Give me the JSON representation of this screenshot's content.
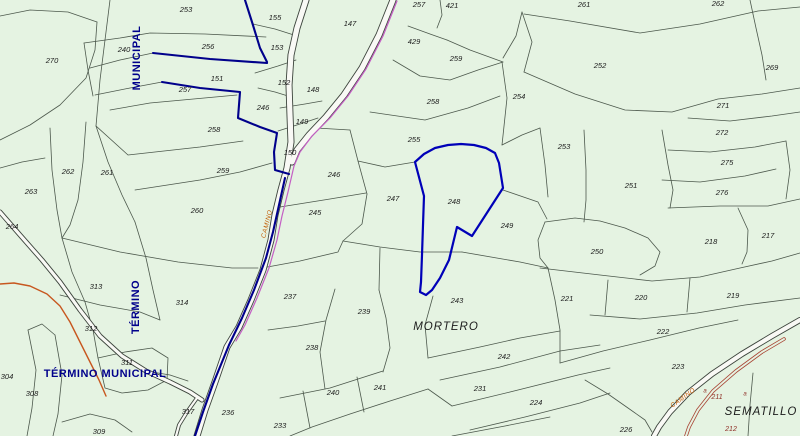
{
  "map": {
    "background_color": "#e5f3e2",
    "parcel_line_color": "#4c584c",
    "road_casing_color": "#3c443c",
    "road_fill_color": "#f9f9f5",
    "highlight_color": "#0000b8",
    "boundary_color": "#00008b",
    "magenta_road_color": "#c45ec4",
    "orange_road_color": "#c7571f",
    "red_path_color": "#a84434",
    "label_color": "#1c1c1c",
    "muni_text_color": "#00008b",
    "camino_text_color": "#c05a00",
    "red_label_color": "#8f2f26",
    "place_names": [
      {
        "t": "MORTERO",
        "x": 446,
        "y": 327
      },
      {
        "t": "SEMATILLO",
        "x": 761,
        "y": 412
      }
    ],
    "municipal_labels": [
      {
        "t": "MUNICIPAL",
        "x": 137,
        "y": 58,
        "r": -90
      },
      {
        "t": "TÉRMINO",
        "x": 136,
        "y": 307,
        "r": -90
      },
      {
        "t": "TÉRMINO MUNICIPAL",
        "x": 105,
        "y": 374,
        "r": 0
      }
    ],
    "camino_labels": [
      {
        "t": "CAMINO",
        "x": 267,
        "y": 224,
        "r": -76
      },
      {
        "t": "CAMINO",
        "x": 683,
        "y": 398,
        "r": -36
      }
    ],
    "red_labels": [
      {
        "t": "211",
        "x": 717,
        "y": 397
      },
      {
        "t": "212",
        "x": 731,
        "y": 429
      },
      {
        "t": "a",
        "x": 705,
        "y": 391
      },
      {
        "t": "a",
        "x": 745,
        "y": 394
      }
    ],
    "parcel_labels": [
      {
        "t": "253",
        "x": 186,
        "y": 10
      },
      {
        "t": "155",
        "x": 275,
        "y": 18
      },
      {
        "t": "147",
        "x": 350,
        "y": 24
      },
      {
        "t": "257",
        "x": 419,
        "y": 5
      },
      {
        "t": "421",
        "x": 452,
        "y": 6
      },
      {
        "t": "429",
        "x": 414,
        "y": 42
      },
      {
        "t": "259",
        "x": 456,
        "y": 59
      },
      {
        "t": "261",
        "x": 584,
        "y": 5
      },
      {
        "t": "262",
        "x": 718,
        "y": 4
      },
      {
        "t": "270",
        "x": 52,
        "y": 61
      },
      {
        "t": "240",
        "x": 124,
        "y": 50
      },
      {
        "t": "256",
        "x": 208,
        "y": 47
      },
      {
        "t": "153",
        "x": 277,
        "y": 48
      },
      {
        "t": "151",
        "x": 217,
        "y": 79
      },
      {
        "t": "257",
        "x": 185,
        "y": 90
      },
      {
        "t": "152",
        "x": 284,
        "y": 83
      },
      {
        "t": "148",
        "x": 313,
        "y": 90
      },
      {
        "t": "246",
        "x": 263,
        "y": 108
      },
      {
        "t": "149",
        "x": 302,
        "y": 122
      },
      {
        "t": "258",
        "x": 214,
        "y": 130
      },
      {
        "t": "254",
        "x": 519,
        "y": 97
      },
      {
        "t": "258",
        "x": 433,
        "y": 102
      },
      {
        "t": "255",
        "x": 414,
        "y": 140
      },
      {
        "t": "252",
        "x": 600,
        "y": 66
      },
      {
        "t": "269",
        "x": 772,
        "y": 68
      },
      {
        "t": "271",
        "x": 723,
        "y": 106
      },
      {
        "t": "272",
        "x": 722,
        "y": 133
      },
      {
        "t": "253",
        "x": 564,
        "y": 147
      },
      {
        "t": "275",
        "x": 727,
        "y": 163
      },
      {
        "t": "251",
        "x": 631,
        "y": 186
      },
      {
        "t": "276",
        "x": 722,
        "y": 193
      },
      {
        "t": "150",
        "x": 290,
        "y": 153
      },
      {
        "t": "259",
        "x": 223,
        "y": 171
      },
      {
        "t": "262",
        "x": 68,
        "y": 172
      },
      {
        "t": "261",
        "x": 107,
        "y": 173
      },
      {
        "t": "263",
        "x": 31,
        "y": 192
      },
      {
        "t": "260",
        "x": 197,
        "y": 211
      },
      {
        "t": "264",
        "x": 12,
        "y": 227
      },
      {
        "t": "246",
        "x": 334,
        "y": 175
      },
      {
        "t": "245",
        "x": 315,
        "y": 213
      },
      {
        "t": "247",
        "x": 393,
        "y": 199
      },
      {
        "t": "248",
        "x": 454,
        "y": 202
      },
      {
        "t": "249",
        "x": 507,
        "y": 226
      },
      {
        "t": "250",
        "x": 597,
        "y": 252
      },
      {
        "t": "218",
        "x": 711,
        "y": 242
      },
      {
        "t": "217",
        "x": 768,
        "y": 236
      },
      {
        "t": "221",
        "x": 567,
        "y": 299
      },
      {
        "t": "220",
        "x": 641,
        "y": 298
      },
      {
        "t": "219",
        "x": 733,
        "y": 296
      },
      {
        "t": "222",
        "x": 663,
        "y": 332
      },
      {
        "t": "223",
        "x": 678,
        "y": 367
      },
      {
        "t": "237",
        "x": 290,
        "y": 297
      },
      {
        "t": "239",
        "x": 364,
        "y": 312
      },
      {
        "t": "238",
        "x": 312,
        "y": 348
      },
      {
        "t": "243",
        "x": 457,
        "y": 301
      },
      {
        "t": "242",
        "x": 504,
        "y": 357
      },
      {
        "t": "231",
        "x": 480,
        "y": 389
      },
      {
        "t": "224",
        "x": 536,
        "y": 403
      },
      {
        "t": "241",
        "x": 380,
        "y": 388
      },
      {
        "t": "240",
        "x": 333,
        "y": 393
      },
      {
        "t": "233",
        "x": 280,
        "y": 426
      },
      {
        "t": "226",
        "x": 626,
        "y": 430
      },
      {
        "t": "313",
        "x": 96,
        "y": 287
      },
      {
        "t": "314",
        "x": 182,
        "y": 303
      },
      {
        "t": "312",
        "x": 91,
        "y": 329
      },
      {
        "t": "311",
        "x": 127,
        "y": 363
      },
      {
        "t": "304",
        "x": 7,
        "y": 377
      },
      {
        "t": "308",
        "x": 32,
        "y": 394
      },
      {
        "t": "317",
        "x": 188,
        "y": 412
      },
      {
        "t": "236",
        "x": 228,
        "y": 413
      },
      {
        "t": "309",
        "x": 99,
        "y": 432
      }
    ],
    "parcel_lines": [
      [
        0,
        16,
        30,
        10,
        68,
        12,
        97,
        22
      ],
      [
        97,
        22,
        95,
        50,
        86,
        78,
        60,
        105,
        30,
        125,
        0,
        140
      ],
      [
        110,
        0,
        105,
        40,
        100,
        80,
        96,
        126
      ],
      [
        84,
        43,
        120,
        38,
        150,
        33,
        205,
        34,
        266,
        37
      ],
      [
        84,
        43,
        88,
        70,
        93,
        96
      ],
      [
        90,
        68,
        120,
        60,
        153,
        53
      ],
      [
        95,
        95,
        130,
        88,
        162,
        82
      ],
      [
        110,
        110,
        150,
        103,
        237,
        95
      ],
      [
        96,
        126,
        128,
        155,
        200,
        147,
        243,
        141
      ],
      [
        96,
        126,
        108,
        162,
        122,
        195,
        135,
        222
      ],
      [
        135,
        190,
        200,
        180,
        240,
        172,
        272,
        163
      ],
      [
        62,
        238,
        120,
        252,
        178,
        262,
        232,
        268,
        258,
        268
      ],
      [
        50,
        128,
        52,
        170,
        57,
        210,
        62,
        238
      ],
      [
        86,
        122,
        83,
        162,
        78,
        200,
        70,
        225,
        62,
        238
      ],
      [
        0,
        168,
        22,
        162,
        45,
        158
      ],
      [
        62,
        238,
        72,
        272,
        85,
        302,
        93,
        330,
        98,
        358
      ],
      [
        98,
        358,
        125,
        352,
        152,
        348,
        168,
        358,
        167,
        380,
        148,
        390,
        122,
        393,
        105,
        388,
        98,
        358
      ],
      [
        135,
        222,
        146,
        258,
        153,
        290,
        160,
        320
      ],
      [
        60,
        295,
        100,
        305,
        140,
        312,
        160,
        320
      ],
      [
        28,
        330,
        36,
        370,
        32,
        408,
        27,
        436
      ],
      [
        55,
        335,
        62,
        375,
        58,
        414,
        53,
        436
      ],
      [
        28,
        330,
        42,
        324,
        55,
        335
      ],
      [
        62,
        422,
        90,
        414,
        115,
        420,
        132,
        432
      ],
      [
        253,
        24,
        275,
        29,
        297,
        36
      ],
      [
        255,
        73,
        278,
        66,
        296,
        60
      ],
      [
        258,
        88,
        275,
        92,
        288,
        96
      ],
      [
        280,
        108,
        305,
        104,
        322,
        101
      ],
      [
        278,
        131,
        300,
        124,
        318,
        118
      ],
      [
        370,
        112,
        425,
        120,
        468,
        108,
        500,
        96
      ],
      [
        393,
        60,
        420,
        76,
        450,
        80,
        478,
        70,
        503,
        62
      ],
      [
        447,
        40,
        470,
        50,
        503,
        62
      ],
      [
        408,
        26,
        430,
        34,
        447,
        40
      ],
      [
        440,
        0,
        442,
        15,
        437,
        28
      ],
      [
        503,
        58,
        516,
        36,
        522,
        12
      ],
      [
        522,
        12,
        532,
        42,
        524,
        72
      ],
      [
        502,
        62,
        507,
        98,
        502,
        145
      ],
      [
        524,
        14,
        570,
        21,
        640,
        33,
        700,
        24,
        758,
        11,
        800,
        7
      ],
      [
        524,
        72,
        575,
        94,
        625,
        110,
        672,
        112,
        718,
        99,
        762,
        94,
        800,
        88
      ],
      [
        688,
        118,
        730,
        121,
        772,
        116,
        800,
        112
      ],
      [
        668,
        150,
        710,
        152,
        755,
        147,
        786,
        141
      ],
      [
        662,
        180,
        700,
        182,
        745,
        176,
        776,
        169
      ],
      [
        668,
        208,
        720,
        206,
        768,
        206,
        800,
        199
      ],
      [
        786,
        141,
        790,
        170,
        786,
        199
      ],
      [
        750,
        0,
        756,
        28,
        762,
        55,
        766,
        80
      ],
      [
        502,
        145,
        522,
        135,
        540,
        128
      ],
      [
        540,
        128,
        545,
        165,
        548,
        197
      ],
      [
        584,
        130,
        586,
        170,
        586,
        200,
        584,
        222
      ],
      [
        662,
        130,
        668,
        165,
        673,
        190,
        670,
        208
      ],
      [
        545,
        222,
        575,
        218,
        600,
        221,
        625,
        228,
        648,
        238,
        660,
        252,
        655,
        266,
        640,
        275
      ],
      [
        545,
        222,
        538,
        240,
        540,
        258,
        548,
        268
      ],
      [
        540,
        268,
        600,
        275,
        652,
        281,
        700,
        277,
        740,
        268,
        772,
        261,
        800,
        253
      ],
      [
        738,
        208,
        748,
        230,
        747,
        252,
        742,
        264
      ],
      [
        503,
        190,
        538,
        202,
        547,
        219
      ],
      [
        462,
        252,
        520,
        262,
        548,
        268
      ],
      [
        548,
        268,
        555,
        300,
        560,
        330,
        560,
        363
      ],
      [
        590,
        315,
        640,
        319,
        697,
        313,
        745,
        305,
        800,
        298
      ],
      [
        608,
        280,
        605,
        315
      ],
      [
        690,
        278,
        687,
        312
      ],
      [
        560,
        363,
        603,
        351,
        650,
        340,
        699,
        328,
        738,
        320
      ],
      [
        585,
        380,
        608,
        394,
        628,
        408,
        645,
        420,
        652,
        432
      ],
      [
        428,
        358,
        480,
        347,
        520,
        338,
        560,
        331
      ],
      [
        440,
        380,
        500,
        367,
        560,
        351,
        600,
        345
      ],
      [
        452,
        406,
        510,
        392,
        578,
        375,
        610,
        368
      ],
      [
        470,
        430,
        525,
        417,
        580,
        403,
        610,
        393
      ],
      [
        452,
        436,
        505,
        426,
        550,
        417
      ],
      [
        433,
        296,
        425,
        325,
        428,
        358
      ],
      [
        280,
        398,
        330,
        388,
        383,
        371
      ],
      [
        290,
        436,
        312,
        427,
        350,
        414,
        390,
        401,
        428,
        389
      ],
      [
        428,
        389,
        452,
        406
      ],
      [
        303,
        391,
        310,
        428
      ],
      [
        357,
        377,
        364,
        412
      ],
      [
        268,
        330,
        298,
        326,
        325,
        321
      ],
      [
        335,
        289,
        326,
        320,
        320,
        352,
        325,
        389
      ],
      [
        262,
        268,
        300,
        261,
        338,
        252,
        343,
        241
      ],
      [
        343,
        241,
        362,
        224,
        367,
        194
      ],
      [
        280,
        207,
        330,
        199,
        366,
        193
      ],
      [
        358,
        161,
        367,
        194
      ],
      [
        316,
        128,
        350,
        130
      ],
      [
        350,
        130,
        358,
        161,
        385,
        167,
        415,
        162
      ],
      [
        343,
        241,
        380,
        247,
        420,
        252,
        462,
        252
      ],
      [
        380,
        248,
        379,
        290
      ],
      [
        379,
        290,
        386,
        318,
        390,
        348,
        383,
        372
      ],
      [
        753,
        373,
        750,
        405,
        748,
        436
      ],
      [
        152,
        372,
        170,
        375,
        188,
        381
      ]
    ],
    "roads": [
      {
        "w": 7,
        "pts": [
          306,
          0,
          297,
          28,
          291,
          55,
          289,
          85,
          290,
          115,
          291,
          142,
          287,
          168,
          281,
          190,
          275,
          215,
          271,
          240,
          263,
          270,
          251,
          300,
          239,
          327,
          227,
          347,
          215,
          382,
          205,
          410,
          197,
          436
        ]
      },
      {
        "w": 7,
        "pts": [
          393,
          0,
          379,
          35,
          362,
          68,
          344,
          95,
          326,
          117,
          309,
          135,
          297,
          150,
          292,
          162
        ]
      },
      {
        "w": 5,
        "pts": [
          0,
          212,
          20,
          235,
          42,
          260,
          60,
          282,
          80,
          310,
          100,
          336,
          122,
          356,
          146,
          371,
          170,
          382,
          190,
          392,
          202,
          400
        ]
      },
      {
        "w": 4,
        "pts": [
          197,
          398,
          187,
          412,
          179,
          425,
          176,
          436
        ]
      },
      {
        "w": 6,
        "pts": [
          800,
          320,
          772,
          336,
          742,
          354,
          712,
          374,
          688,
          393,
          670,
          412,
          659,
          427,
          654,
          436
        ]
      }
    ],
    "magenta_line": [
      397,
      1,
      383,
      36,
      366,
      69,
      348,
      96,
      330,
      118,
      312,
      136,
      300,
      152,
      294,
      166,
      288,
      192,
      282,
      216,
      277,
      240,
      269,
      268,
      257,
      298,
      245,
      325,
      236,
      341
    ],
    "orange_road": [
      0,
      284,
      14,
      283,
      30,
      286,
      47,
      294,
      60,
      306,
      70,
      322,
      80,
      342,
      90,
      362,
      99,
      380,
      106,
      396
    ],
    "red_path": [
      784,
      339,
      762,
      352,
      736,
      371,
      713,
      391,
      698,
      410,
      689,
      427,
      686,
      436
    ],
    "navy_lines": [
      [
        245,
        0,
        252,
        22,
        260,
        48,
        267,
        62
      ],
      [
        153,
        53,
        210,
        59,
        267,
        63
      ],
      [
        162,
        82,
        200,
        88,
        240,
        92,
        238,
        118,
        260,
        127,
        277,
        133,
        274,
        152,
        275,
        170,
        289,
        174
      ],
      [
        285,
        178,
        279,
        205,
        273,
        232,
        266,
        258,
        254,
        290,
        242,
        318,
        229,
        345,
        213,
        384,
        203,
        412,
        195,
        436
      ]
    ],
    "highlight_parcel": [
      415,
      162,
      424,
      154,
      435,
      148,
      448,
      145,
      461,
      144,
      474,
      145,
      486,
      148,
      495,
      153,
      499,
      163,
      503,
      188,
      472,
      236,
      457,
      227,
      449,
      260,
      440,
      278,
      432,
      290,
      426,
      295,
      420,
      292,
      421,
      282,
      422,
      255,
      423,
      225,
      424,
      196
    ]
  }
}
